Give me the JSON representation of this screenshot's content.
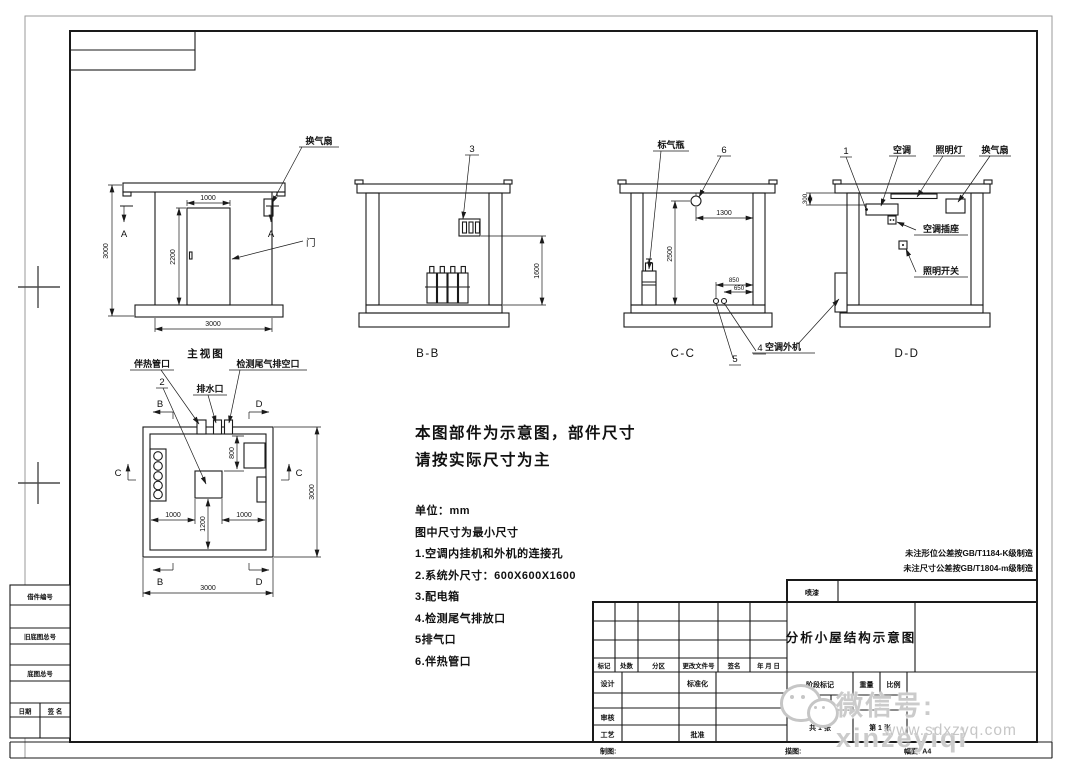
{
  "views": {
    "front": {
      "name": "主视图",
      "fan": "换气扇",
      "door": "门",
      "a": "A",
      "d1000": "1000",
      "d2200": "2200",
      "d3000l": "3000",
      "d3000b": "3000"
    },
    "bb": {
      "label": "B-B",
      "c3": "3",
      "d1600": "1600"
    },
    "cc": {
      "label": "C-C",
      "bottle": "标气瓶",
      "c6": "6",
      "c5": "5",
      "c4": "4",
      "d1300": "1300",
      "d2500": "2500",
      "d850": "850",
      "d650": "650"
    },
    "dd": {
      "label": "D-D",
      "c1": "1",
      "ac": "空调",
      "lamp": "照明灯",
      "fan": "换气扇",
      "socket": "空调插座",
      "switch": "照明开关",
      "outdoor": "空调外机",
      "d300": "300"
    },
    "plan": {
      "heat": "伴热管口",
      "c2": "2",
      "drain": "排水口",
      "exhaust": "检测尾气排空口",
      "b": "B",
      "c": "C",
      "d": "D",
      "d800": "800",
      "d1000l": "1000",
      "d1200": "1200",
      "d1000r": "1000",
      "d3000r": "3000",
      "d3000b": "3000"
    }
  },
  "notes": {
    "l1": "本图部件为示意图，部件尺寸",
    "l2": "请按实际尺寸为主",
    "items": [
      "单位：mm",
      "图中尺寸为最小尺寸",
      "1.空调内挂机和外机的连接孔",
      "2.系统外尺寸：600X600X1600",
      "3.配电箱",
      "4.检测尾气排放口",
      "5排气口",
      "6.伴热管口"
    ]
  },
  "tolerance": {
    "l1": "未注形位公差按GB/T1184-K级制造",
    "l2": "未注尺寸公差按GB/T1804-m级制造"
  },
  "titleblock": {
    "coating": "喷漆",
    "title": "分析小屋结构示意图",
    "rev": [
      "标记",
      "处数",
      "分区",
      "更改文件号",
      "签名",
      "年 月 日"
    ],
    "design": "设计",
    "std": "标准化",
    "audit": "审核",
    "craft": "工艺",
    "approve": "批准",
    "stage": "阶段标记",
    "weight": "重量",
    "scale": "比例",
    "sheets": "共 1 张",
    "sheet_no": "第 1 张"
  },
  "strip": {
    "draft": "制图:",
    "trace": "描图:",
    "format": "幅面: A4"
  },
  "margins": {
    "borrow": "借件编号",
    "old_base": "旧底图总号",
    "base": "底图总号",
    "date": "日期",
    "sign": "签 名"
  },
  "watermark": {
    "id": "微信号: xinzeyiqi",
    "site": "www.sdxzyq.com"
  }
}
